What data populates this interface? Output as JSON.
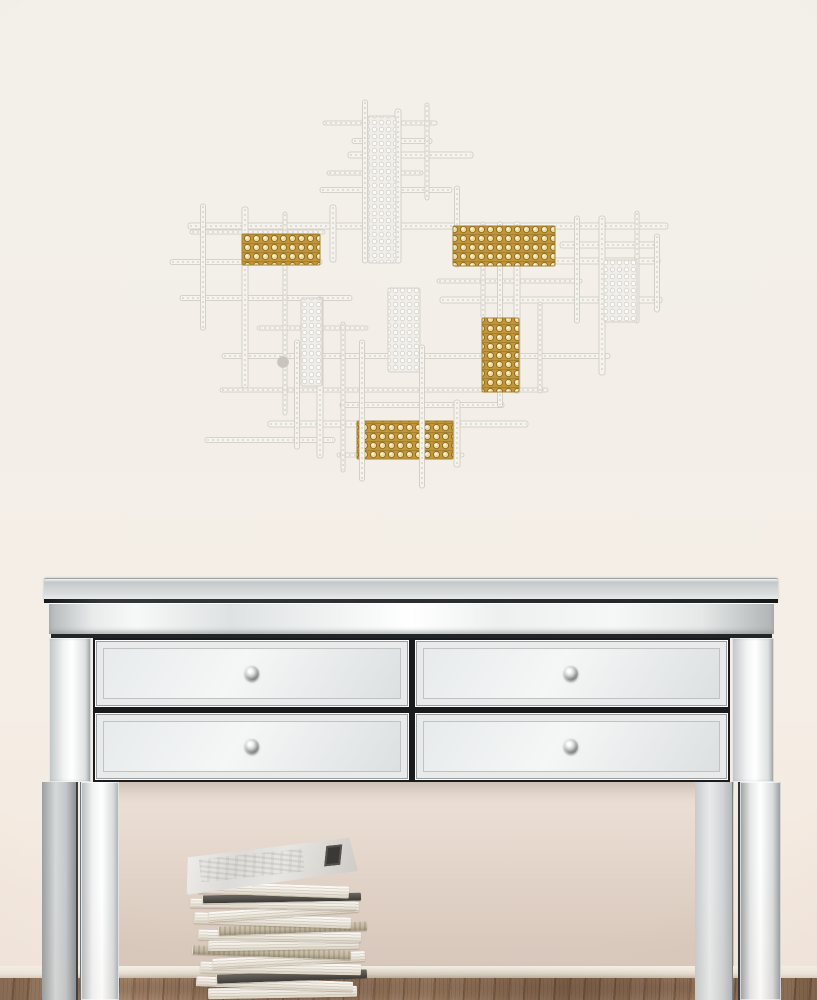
{
  "scene": {
    "labels": {
      "scene": "Room scene",
      "artwork": "Grid wall sculpture with gold crystal accents",
      "console": "Mirrored 4-drawer console table",
      "books": "Stack of magazines",
      "floor": "Wood floor",
      "baseboard": "Baseboard"
    },
    "palette": {
      "wall-top": "#f3f0ea",
      "wall-bottom": "#f3e8de",
      "silver-light": "#ffffff",
      "silver-mid": "#d9dcdc",
      "seam": "#232627",
      "floor-mid": "#8a684e",
      "floor-dark": "#6f5238",
      "floor-light": "#a58264",
      "book-page": "#f2eee5",
      "book-dark": "#504d49",
      "book-tan": "#c1b6a0"
    }
  },
  "artwork": {
    "frame": {
      "x": 170,
      "y": 92,
      "w": 510,
      "h": 410
    },
    "colors": {
      "bar": "#f5f3ee",
      "bar_edge": "#ccc8bf",
      "bar_tex": "#b9b4a9",
      "gold_bg": "#c39739",
      "gold_hi": "#eeda9f",
      "gold_edge": "#8f6d22",
      "gold_border": "#a38030",
      "mesh_bg": "#f0eeea",
      "mesh_dot": "#fbfaf7",
      "mesh_edge": "#d6d2c9",
      "dot": "#c9c5bc"
    },
    "h_bars": [
      [
        323,
        437,
        123
      ],
      [
        352,
        432,
        141
      ],
      [
        348,
        473,
        155
      ],
      [
        327,
        423,
        173
      ],
      [
        320,
        452,
        190
      ],
      [
        188,
        668,
        226
      ],
      [
        190,
        325,
        232
      ],
      [
        170,
        322,
        262
      ],
      [
        455,
        660,
        261
      ],
      [
        437,
        582,
        281
      ],
      [
        180,
        352,
        298
      ],
      [
        440,
        662,
        300
      ],
      [
        257,
        368,
        328
      ],
      [
        222,
        610,
        356
      ],
      [
        560,
        658,
        245
      ],
      [
        220,
        548,
        390
      ],
      [
        340,
        504,
        405
      ],
      [
        268,
        528,
        424
      ],
      [
        337,
        464,
        455
      ],
      [
        205,
        335,
        440
      ]
    ],
    "v_bars": [
      [
        203,
        204,
        330
      ],
      [
        245,
        207,
        388
      ],
      [
        285,
        212,
        415
      ],
      [
        297,
        340,
        449
      ],
      [
        320,
        297,
        458
      ],
      [
        343,
        322,
        472
      ],
      [
        365,
        100,
        263
      ],
      [
        398,
        109,
        263
      ],
      [
        427,
        103,
        200
      ],
      [
        457,
        186,
        267
      ],
      [
        457,
        400,
        467
      ],
      [
        483,
        222,
        318
      ],
      [
        500,
        222,
        407
      ],
      [
        517,
        222,
        393
      ],
      [
        540,
        302,
        393
      ],
      [
        577,
        216,
        323
      ],
      [
        602,
        216,
        375
      ],
      [
        637,
        211,
        323
      ],
      [
        657,
        234,
        312
      ],
      [
        333,
        205,
        262
      ]
    ],
    "front_v_bars": [
      [
        362,
        340,
        481
      ],
      [
        422,
        345,
        488
      ]
    ],
    "mesh_strips": [
      [
        368,
        116,
        28,
        147
      ],
      [
        388,
        288,
        32,
        84
      ],
      [
        301,
        298,
        21,
        88
      ],
      [
        604,
        260,
        33,
        62
      ]
    ],
    "gold_blocks": [
      [
        242,
        234,
        78,
        31
      ],
      [
        453,
        226,
        102,
        40
      ],
      [
        482,
        318,
        37,
        74
      ],
      [
        357,
        421,
        96,
        38
      ]
    ],
    "dots": [
      [
        283,
        362,
        5.5
      ]
    ]
  },
  "console": {
    "drawer_rows": 2,
    "drawer_cols": 2,
    "knob_count": 4
  },
  "books": {
    "items": [
      {
        "w": 148,
        "h": 11,
        "x": 30,
        "rot": -1,
        "tone": "pages"
      },
      {
        "w": 156,
        "h": 10,
        "x": 18,
        "rot": 2,
        "tone": "pages"
      },
      {
        "w": 150,
        "h": 9,
        "x": 38,
        "rot": -2,
        "tone": "dark"
      },
      {
        "w": 160,
        "h": 11,
        "x": 22,
        "rot": 1,
        "tone": "pages"
      },
      {
        "w": 152,
        "h": 10,
        "x": 34,
        "rot": -3,
        "tone": "pages"
      },
      {
        "w": 158,
        "h": 9,
        "x": 14,
        "rot": 2,
        "tone": "tan"
      },
      {
        "w": 150,
        "h": 11,
        "x": 30,
        "rot": -1,
        "tone": "pages"
      },
      {
        "w": 162,
        "h": 10,
        "x": 20,
        "rot": 1,
        "tone": "pages"
      },
      {
        "w": 148,
        "h": 9,
        "x": 40,
        "rot": -2,
        "tone": "tan"
      },
      {
        "w": 156,
        "h": 11,
        "x": 16,
        "rot": 2,
        "tone": "pages"
      },
      {
        "w": 150,
        "h": 10,
        "x": 30,
        "rot": -4,
        "tone": "pages"
      },
      {
        "w": 165,
        "h": 9,
        "x": 12,
        "rot": 1,
        "tone": "pages"
      },
      {
        "w": 158,
        "h": 8,
        "x": 24,
        "rot": -1,
        "tone": "dark"
      },
      {
        "w": 150,
        "h": 12,
        "x": 20,
        "rot": 2,
        "tone": "pages"
      },
      {
        "w": 172,
        "h": 40,
        "x": 6,
        "rot": -6,
        "tone": "top-cover"
      }
    ]
  }
}
